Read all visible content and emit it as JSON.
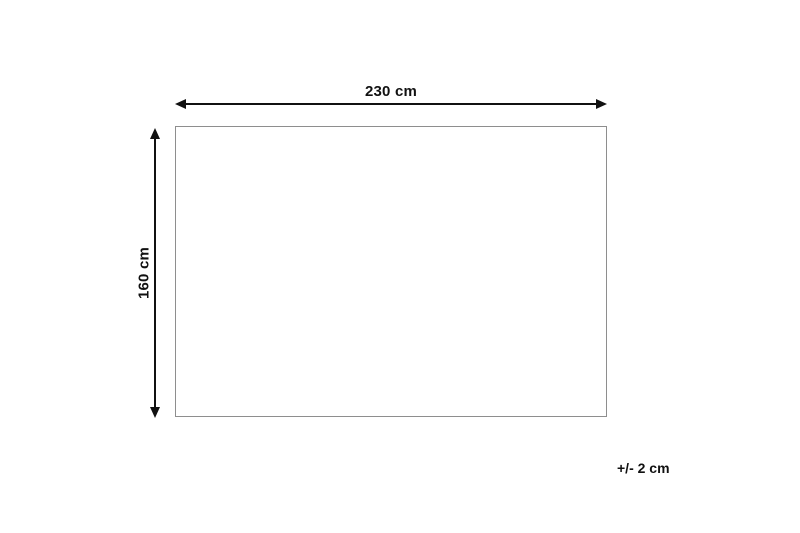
{
  "diagram": {
    "type": "product-dimension-diagram",
    "width_label": "230 cm",
    "height_label": "160 cm",
    "tolerance_label": "+/- 2 cm",
    "colors": {
      "background": "#ffffff",
      "arrow": "#111111",
      "outline": "#8e8e8e",
      "text": "#111111"
    }
  }
}
